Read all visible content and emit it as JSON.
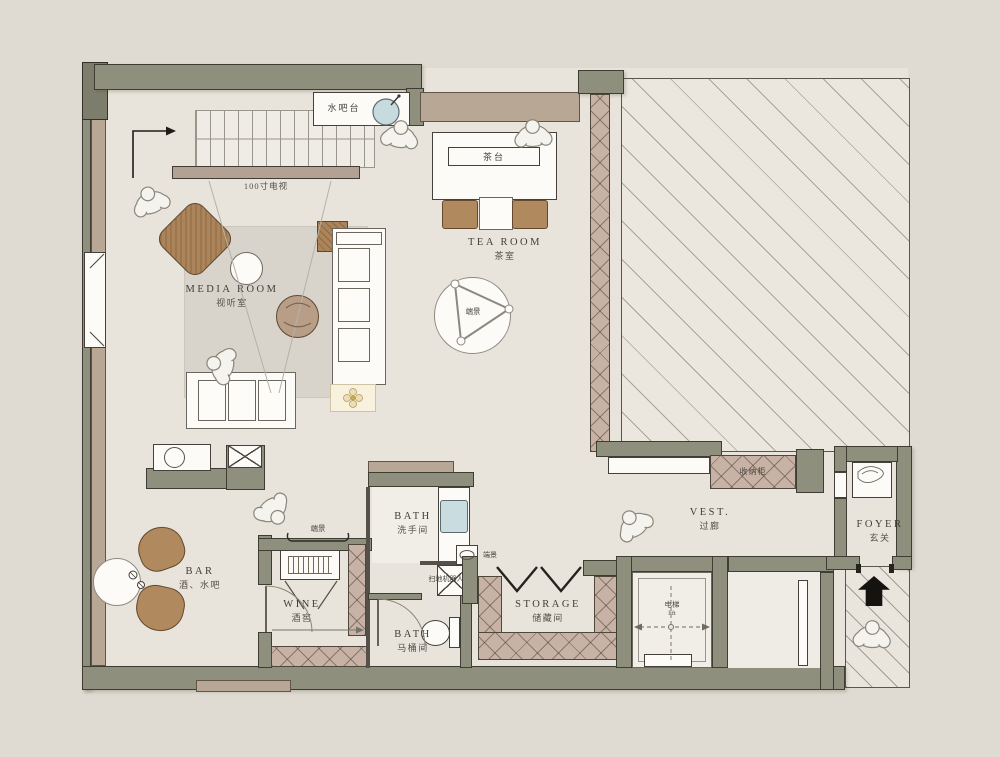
{
  "rooms": {
    "media_room": {
      "en": "MEDIA ROOM",
      "zh": "视听室"
    },
    "tea_room": {
      "en": "TEA ROOM",
      "zh": "茶室"
    },
    "bar": {
      "en": "BAR",
      "zh": "酒、水吧"
    },
    "wine": {
      "en": "WINE",
      "zh": "酒窖"
    },
    "bath_wash": {
      "en": "BATH",
      "zh": "洗手间"
    },
    "bath_wc": {
      "en": "BATH",
      "zh": "马桶间"
    },
    "storage": {
      "en": "STORAGE",
      "zh": "储藏间"
    },
    "vestibule": {
      "en": "VEST.",
      "zh": "过廊"
    },
    "foyer": {
      "en": "FOYER",
      "zh": "玄关"
    }
  },
  "fixtures": {
    "water_bar": "水吧台",
    "tv_100": "100寸电视",
    "tea_table": "茶台",
    "end_view": "端景",
    "robot_vacuum": "扫地机器人",
    "storage_cabinet": "收纳柜",
    "elevator": {
      "zh": "电梯",
      "en": "lift"
    }
  },
  "colors": {
    "background": "#dfdbd2",
    "floor": "#e8e4db",
    "wall_olive": "#8f8f7d",
    "wall_tan": "#b9a795",
    "lattice_tan": "#c7b2a5",
    "wood_brown": "#ab8459",
    "rug_gray": "#d8d4cc",
    "sink_blue": "#c9dde0",
    "line_dark": "#3f3c33"
  }
}
